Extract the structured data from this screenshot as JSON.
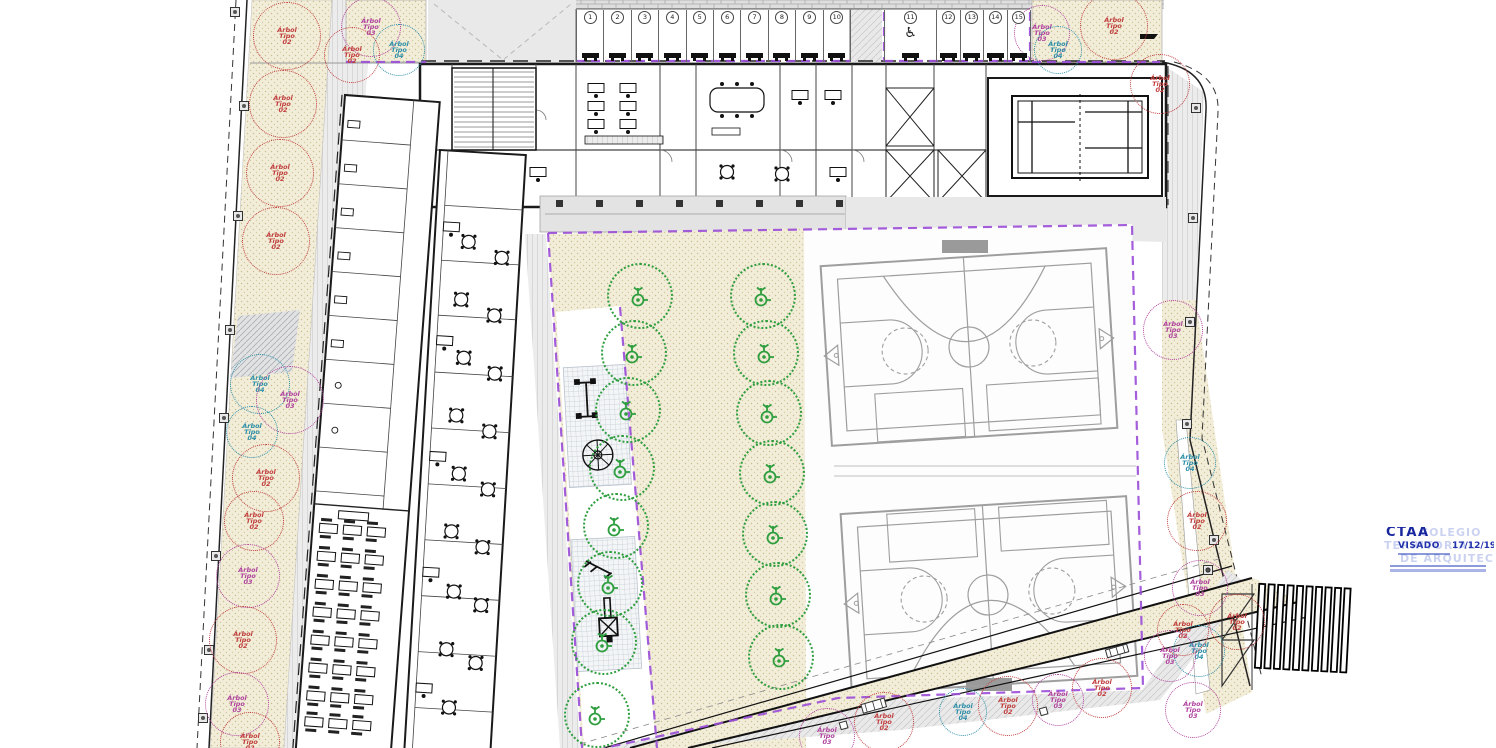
{
  "stamp": {
    "org": "CTAA",
    "status": "VISADO",
    "date": "17/12/19",
    "watermark": [
      "COLEGIO",
      "TERRITORIAL",
      "DE ARQUITECTOS"
    ]
  },
  "parking": {
    "left_stalls": [
      "1",
      "2",
      "3",
      "4",
      "5",
      "6",
      "7",
      "8",
      "9",
      "10"
    ],
    "right_stalls": [
      "11",
      "12",
      "13",
      "14",
      "15"
    ],
    "accessible_stall": "11"
  },
  "trees": {
    "types": [
      {
        "id": "01",
        "label": "Árbol Tipo 01",
        "color": "#2f9e3f"
      },
      {
        "id": "02",
        "label": "Árbol Tipo 02",
        "color": "#c13f3f"
      },
      {
        "id": "03",
        "label": "Árbol Tipo 03",
        "color": "#b0449e"
      },
      {
        "id": "04",
        "label": "Árbol Tipo 04",
        "color": "#2e8fa8"
      }
    ],
    "courtyard": {
      "type": "01",
      "radius": 33,
      "positions": [
        [
          640,
          296
        ],
        [
          634,
          353
        ],
        [
          628,
          410
        ],
        [
          622,
          468
        ],
        [
          616,
          526
        ],
        [
          610,
          584
        ],
        [
          604,
          642
        ],
        [
          597,
          715
        ],
        [
          763,
          296
        ],
        [
          766,
          353
        ],
        [
          769,
          413
        ],
        [
          772,
          473
        ],
        [
          775,
          534
        ],
        [
          778,
          595
        ],
        [
          781,
          657
        ]
      ]
    },
    "perimeter": [
      {
        "x": 287,
        "y": 36,
        "t": "02"
      },
      {
        "x": 283,
        "y": 104,
        "t": "02"
      },
      {
        "x": 280,
        "y": 173,
        "t": "02"
      },
      {
        "x": 276,
        "y": 241,
        "t": "02"
      },
      {
        "x": 260,
        "y": 384,
        "t": "04",
        "r": 30
      },
      {
        "x": 290,
        "y": 400,
        "t": "03",
        "r": 34
      },
      {
        "x": 252,
        "y": 432,
        "t": "04",
        "r": 26
      },
      {
        "x": 266,
        "y": 478,
        "t": "02",
        "r": 34
      },
      {
        "x": 254,
        "y": 521,
        "t": "02",
        "r": 30
      },
      {
        "x": 248,
        "y": 576,
        "t": "03",
        "r": 32
      },
      {
        "x": 243,
        "y": 640,
        "t": "02",
        "r": 34
      },
      {
        "x": 237,
        "y": 704,
        "t": "03",
        "r": 32
      },
      {
        "x": 250,
        "y": 742,
        "t": "02",
        "r": 30
      },
      {
        "x": 371,
        "y": 27,
        "t": "03",
        "r": 30
      },
      {
        "x": 399,
        "y": 50,
        "t": "04",
        "r": 26
      },
      {
        "x": 352,
        "y": 55,
        "t": "02",
        "r": 28
      },
      {
        "x": 1042,
        "y": 33,
        "t": "03",
        "r": 28
      },
      {
        "x": 1058,
        "y": 50,
        "t": "04",
        "r": 24
      },
      {
        "x": 1114,
        "y": 26,
        "t": "02",
        "r": 34
      },
      {
        "x": 1160,
        "y": 84,
        "t": "02",
        "r": 30
      },
      {
        "x": 1173,
        "y": 330,
        "t": "03",
        "r": 30
      },
      {
        "x": 1190,
        "y": 463,
        "t": "04",
        "r": 26
      },
      {
        "x": 1197,
        "y": 521,
        "t": "02",
        "r": 30
      },
      {
        "x": 1200,
        "y": 588,
        "t": "03",
        "r": 28
      },
      {
        "x": 1199,
        "y": 651,
        "t": "04",
        "r": 26
      },
      {
        "x": 1193,
        "y": 710,
        "t": "03",
        "r": 28
      },
      {
        "x": 1183,
        "y": 630,
        "t": "02",
        "r": 26
      },
      {
        "x": 827,
        "y": 736,
        "t": "03",
        "r": 28
      },
      {
        "x": 884,
        "y": 722,
        "t": "02",
        "r": 30
      },
      {
        "x": 963,
        "y": 712,
        "t": "04",
        "r": 24
      },
      {
        "x": 1008,
        "y": 706,
        "t": "02",
        "r": 30
      },
      {
        "x": 1058,
        "y": 700,
        "t": "03",
        "r": 26
      },
      {
        "x": 1102,
        "y": 688,
        "t": "02",
        "r": 30
      },
      {
        "x": 1170,
        "y": 656,
        "t": "03",
        "r": 26
      },
      {
        "x": 1237,
        "y": 622,
        "t": "02",
        "r": 28
      }
    ]
  },
  "colors": {
    "sand": "#f2edd8",
    "court_lines": "#9e9e9e",
    "boundary": "#9c4fd8",
    "walls": "#1a1a1a",
    "road": "#e9e9e9"
  }
}
